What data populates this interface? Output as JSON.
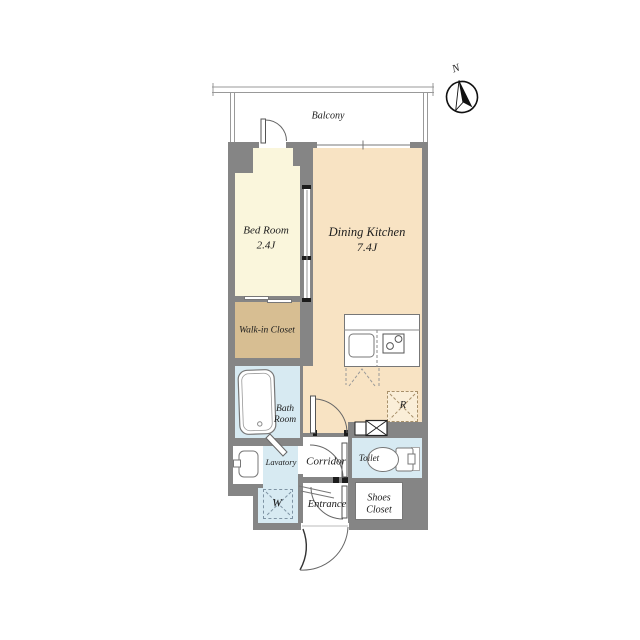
{
  "plan": {
    "balcony_label": "Balcony",
    "compass_label": "N",
    "rooms": {
      "bedroom": {
        "name": "Bed Room",
        "size": "2.4J"
      },
      "dining_kitchen": {
        "name": "Dining Kitchen",
        "size": "7.4J"
      },
      "walk_in_closet": {
        "name": "Walk-in Closet"
      },
      "bath_room": {
        "line1": "Bath",
        "line2": "Room"
      },
      "lavatory": {
        "name": "Lavatory"
      },
      "corridor": {
        "name": "Corridor"
      },
      "toilet": {
        "name": "Toilet"
      },
      "entrance": {
        "name": "Entrance"
      },
      "shoes_closet": {
        "line1": "Shoes",
        "line2": "Closet"
      }
    },
    "markers": {
      "washing_machine": "W",
      "refrigerator": "R"
    },
    "colors": {
      "wall": "#858585",
      "bedroom": "#FAF6DC",
      "dining_kitchen": "#F8E3C3",
      "walk_in_closet": "#D7BE92",
      "wet_area": "#D7EAF2"
    }
  }
}
